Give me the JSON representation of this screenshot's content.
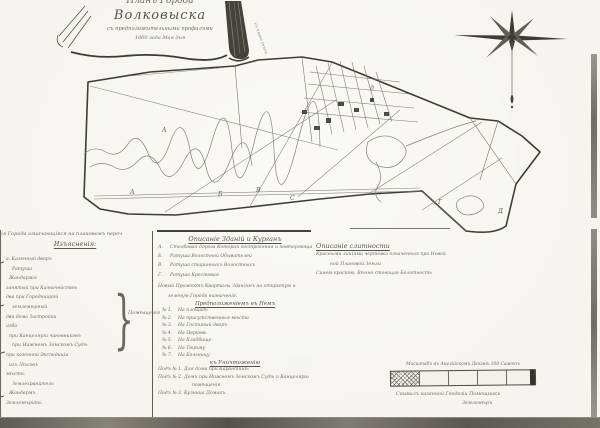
{
  "page": {
    "paper_color": "#f5f4f0",
    "ink_color": "#45423c",
    "faded_ink_color": "#6e6a62"
  },
  "cartouche": {
    "title_line1": "Планъ Города",
    "title_line2": "Волковыска",
    "title_line3": "съ предположительными профилями",
    "title_line4": "1860 года Мая дня",
    "side_note": "съ плана снялъ"
  },
  "map": {
    "labels": [
      "А",
      "А",
      "Б",
      "В",
      "С",
      "Г",
      "Д",
      "д"
    ]
  },
  "legend_left": {
    "top_line": "нія Города означающіяся на плановомъ переч",
    "header": "Изъясненія:",
    "items": [
      "а. Казенный дворъ",
      "Ратуша",
      "Жандармія",
      "занятый при Казначействѣ",
      "два при Городницкой",
      "землемѣрный",
      "два дома Застройки",
      "изба",
      "при Канцеляріи чиновниковъ",
      "при Нижнемъ Земскомъ Судѣ",
      "при казенной Экспедиціи",
      "изъ Лѣсовъ",
      "мѣстн.",
      "Землехранитель",
      "Жандармъ",
      "Землемѣрить"
    ],
    "brace_label": "Помѣщенія"
  },
  "legend_middle": {
    "header": "Описаніе Зданій и Курганъ",
    "lettered": [
      {
        "key": "А.",
        "text": "Столбовая дорога Которая построенная и повторяющаяся"
      },
      {
        "key": "Б.",
        "text": "Ратуша Волостной Обывателей"
      },
      {
        "key": "В.",
        "text": "Ратуша старинныхъ Волостныхъ"
      },
      {
        "key": "Г.",
        "text": "Ратуша Крестовая"
      }
    ],
    "paragraph_line1": "Новый Прожектъ Кварталы Зданіямъ на открытую и",
    "paragraph_line2": "зеленую Города назначенія.",
    "subheader": "Предположеніемъ въ Немъ",
    "numbered": [
      {
        "num": "№ 1.",
        "text": "На площадь"
      },
      {
        "num": "№ 2.",
        "text": "На присутственныя мѣста"
      },
      {
        "num": "№ 3.",
        "text": "На Гостиный дворъ"
      },
      {
        "num": "№ 4.",
        "text": "На Церковь"
      },
      {
        "num": "№ 5.",
        "text": "На Кладбище"
      },
      {
        "num": "№ 6.",
        "text": "На Тюрьму"
      },
      {
        "num": "№ 7.",
        "text": "На Больницу"
      }
    ],
    "under_header": "къ Уничтоженію",
    "under_items": [
      {
        "num": "Подъ № 1.",
        "text": "Для дома при Карантинѣ"
      },
      {
        "num": "Подъ № 2.",
        "text": "Домъ при Нижнемъ Земскомъ Судѣ и Канцеляріи"
      },
      {
        "num": "Подъ № 3.",
        "text": "Кузница Домикъ."
      }
    ],
    "under_continuation": "помѣщенія."
  },
  "legend_right": {
    "header": "Описаніе слитности",
    "line1": "Красными линіями чертежа означенныя при Новой",
    "line2": "ной Плановой Земли",
    "line3": "Синею краскою, Вѣчно стоющая Болотность"
  },
  "scale": {
    "caption": "Масштабъ въ Англійскомъ Дюймѣ 100 Саженъ",
    "signature_line1": "Снималъ казенной Геодезіи Помощникъ",
    "signature_line2": "Землемѣръ"
  }
}
